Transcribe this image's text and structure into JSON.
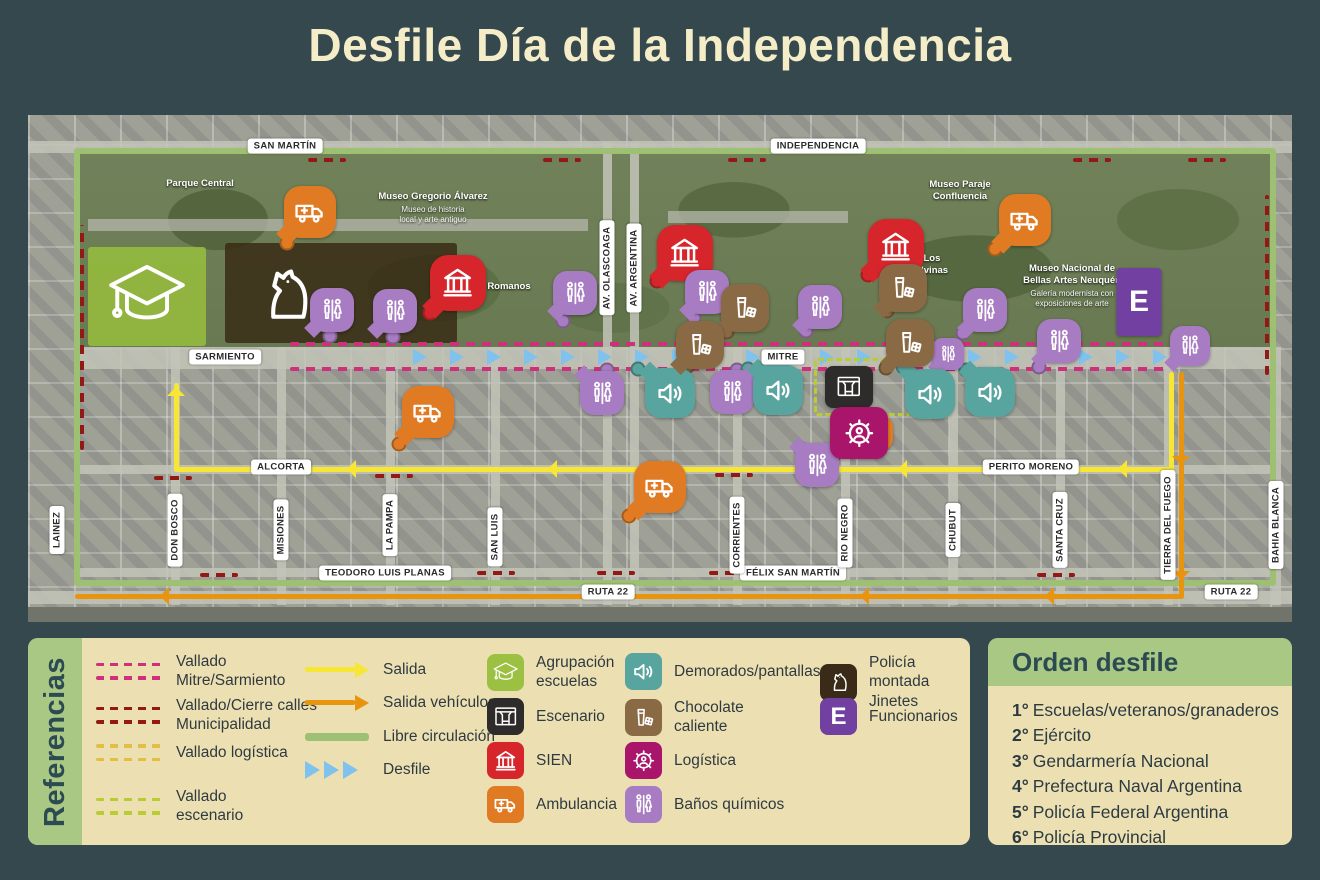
{
  "title": "Desfile Día de la Independencia",
  "map": {
    "street_labels": [
      {
        "text": "SAN MARTÍN",
        "x": 257,
        "y": 31
      },
      {
        "text": "INDEPENDENCIA",
        "x": 790,
        "y": 31
      },
      {
        "text": "SARMIENTO",
        "x": 197,
        "y": 242
      },
      {
        "text": "MITRE",
        "x": 755,
        "y": 242
      },
      {
        "text": "ALCORTA",
        "x": 253,
        "y": 352
      },
      {
        "text": "PERITO MORENO",
        "x": 1003,
        "y": 352
      },
      {
        "text": "TEODORO LUIS PLANAS",
        "x": 357,
        "y": 458
      },
      {
        "text": "FÉLIX SAN MARTÍN",
        "x": 765,
        "y": 458
      },
      {
        "text": "RUTA 22",
        "x": 580,
        "y": 477
      },
      {
        "text": "RUTA 22",
        "x": 1203,
        "y": 477
      },
      {
        "text": "LAINEZ",
        "x": 29,
        "y": 415,
        "v": 1
      },
      {
        "text": "DON BOSCO",
        "x": 147,
        "y": 415,
        "v": 1
      },
      {
        "text": "MISIONES",
        "x": 253,
        "y": 415,
        "v": 1
      },
      {
        "text": "LA PAMPA",
        "x": 362,
        "y": 410,
        "v": 1
      },
      {
        "text": "SAN LUIS",
        "x": 467,
        "y": 422,
        "v": 1
      },
      {
        "text": "CORRIENTES",
        "x": 709,
        "y": 420,
        "v": 1
      },
      {
        "text": "RIO NEGRO",
        "x": 817,
        "y": 418,
        "v": 1
      },
      {
        "text": "CHUBUT",
        "x": 925,
        "y": 415,
        "v": 1
      },
      {
        "text": "SANTA CRUZ",
        "x": 1032,
        "y": 415,
        "v": 1
      },
      {
        "text": "TIERRA DEL FUEGO",
        "x": 1140,
        "y": 410,
        "v": 1
      },
      {
        "text": "BAHIA BLANCA",
        "x": 1248,
        "y": 410,
        "v": 1
      },
      {
        "text": "AV. OLASCOAGA",
        "x": 579,
        "y": 153,
        "v": 1
      },
      {
        "text": "AV. ARGENTINA",
        "x": 606,
        "y": 153,
        "v": 1
      }
    ],
    "place_labels": [
      {
        "text": "Parque Central",
        "x": 172,
        "y": 69
      },
      {
        "text": "Museo Gregorio Álvarez",
        "x": 405,
        "y": 82
      },
      {
        "text": "Museo de historia\nlocal y arte antiguo",
        "x": 405,
        "y": 100,
        "sub": 1
      },
      {
        "text": "Museo Paraje\nConfluencia",
        "x": 932,
        "y": 76
      },
      {
        "text": "s Romanos",
        "x": 477,
        "y": 172
      },
      {
        "text": "a Los\nMalvinas",
        "x": 900,
        "y": 150
      },
      {
        "text": "Museo Nacional de\nBellas Artes Neuquén",
        "x": 1044,
        "y": 160
      },
      {
        "text": "Galería modernista con\nexposiciones de arte",
        "x": 1044,
        "y": 184,
        "sub": 1
      }
    ],
    "markers": [
      {
        "t": "amb",
        "x": 282,
        "y": 97,
        "s": 52,
        "tail": "bl",
        "dot": [
          259,
          128
        ]
      },
      {
        "t": "amb",
        "x": 997,
        "y": 105,
        "s": 52,
        "tail": "bl",
        "dot": [
          967,
          134
        ]
      },
      {
        "t": "amb",
        "x": 400,
        "y": 297,
        "s": 52,
        "tail": "bl",
        "dot": [
          371,
          329
        ]
      },
      {
        "t": "amb",
        "x": 632,
        "y": 372,
        "s": 52,
        "tail": "bl",
        "dot": [
          601,
          401
        ]
      },
      {
        "t": "amb",
        "x": 848,
        "y": 318,
        "s": 34,
        "tail": "bl",
        "dot": [
          833,
          335
        ]
      },
      {
        "t": "sien",
        "x": 430,
        "y": 168,
        "s": 56,
        "tail": "bl",
        "dot": [
          402,
          198
        ]
      },
      {
        "t": "sien",
        "x": 657,
        "y": 138,
        "s": 56,
        "tail": "bl",
        "dot": [
          629,
          166
        ]
      },
      {
        "t": "sien",
        "x": 868,
        "y": 132,
        "s": 56,
        "tail": "bl",
        "dot": [
          840,
          160
        ]
      },
      {
        "t": "banos",
        "x": 304,
        "y": 195,
        "s": 44,
        "tail": "bl",
        "dot": [
          302,
          221
        ]
      },
      {
        "t": "banos",
        "x": 367,
        "y": 196,
        "s": 44,
        "tail": "bl",
        "dot": [
          365,
          222
        ]
      },
      {
        "t": "banos",
        "x": 547,
        "y": 178,
        "s": 44,
        "tail": "bl",
        "dot": [
          535,
          206
        ]
      },
      {
        "t": "banos",
        "x": 679,
        "y": 177,
        "s": 44,
        "tail": "bl",
        "dot": [
          666,
          203
        ]
      },
      {
        "t": "banos",
        "x": 792,
        "y": 192,
        "s": 44,
        "tail": "bl",
        "dot": [
          778,
          216
        ]
      },
      {
        "t": "banos",
        "x": 957,
        "y": 195,
        "s": 44,
        "tail": "bl",
        "dot": [
          935,
          218
        ]
      },
      {
        "t": "banos",
        "x": 1031,
        "y": 226,
        "s": 44,
        "tail": "bl",
        "dot": [
          1011,
          252
        ]
      },
      {
        "t": "banos",
        "x": 1162,
        "y": 231,
        "s": 40,
        "tail": "bl"
      },
      {
        "t": "banos",
        "x": 574,
        "y": 278,
        "s": 44,
        "tail": "tl",
        "dot": [
          579,
          255
        ]
      },
      {
        "t": "banos",
        "x": 704,
        "y": 277,
        "s": 44,
        "tail": "tr",
        "dot": [
          709,
          255
        ]
      },
      {
        "t": "banos",
        "x": 789,
        "y": 350,
        "s": 44,
        "tail": "tl",
        "dot": [
          772,
          333
        ]
      },
      {
        "t": "banos",
        "x": 920,
        "y": 239,
        "s": 32,
        "tail": "bl"
      },
      {
        "t": "speaker",
        "x": 642,
        "y": 278,
        "s": 50,
        "tail": "tl",
        "dot": [
          610,
          254
        ]
      },
      {
        "t": "speaker",
        "x": 750,
        "y": 275,
        "s": 50,
        "tail": "tl",
        "dot": [
          720,
          254
        ]
      },
      {
        "t": "speaker",
        "x": 902,
        "y": 279,
        "s": 50,
        "tail": "tl",
        "dot": [
          875,
          252
        ]
      },
      {
        "t": "speaker",
        "x": 962,
        "y": 277,
        "s": 50,
        "tail": "tl",
        "dot": [
          938,
          255
        ]
      },
      {
        "t": "choc",
        "x": 717,
        "y": 193,
        "s": 48,
        "tail": "bl",
        "dot": [
          699,
          217
        ]
      },
      {
        "t": "choc",
        "x": 875,
        "y": 173,
        "s": 48,
        "tail": "bl",
        "dot": [
          859,
          196
        ]
      },
      {
        "t": "choc",
        "x": 672,
        "y": 230,
        "s": 48,
        "tail": "bl",
        "dot": [
          660,
          251
        ]
      },
      {
        "t": "choc",
        "x": 882,
        "y": 228,
        "s": 48,
        "tail": "bl",
        "dot": [
          858,
          253
        ]
      }
    ]
  },
  "marker_colors": {
    "amb": "#e07b24",
    "sien": "#d6252b",
    "banos": "#a87cc2",
    "speaker": "#58a49e",
    "choc": "#8a6a44"
  },
  "legend": {
    "title": "Referencias",
    "barriers": [
      {
        "label": "Vallado\nMitre/Sarmiento",
        "color": "#cf2f7b"
      },
      {
        "label": "Vallado/Cierre calles\nMunicipalidad",
        "color": "#921914"
      },
      {
        "label": "Vallado logística",
        "color": "#e4bd45"
      },
      {
        "label": "Vallado\nescenario",
        "color": "#b9cc33"
      }
    ],
    "routes": [
      {
        "label": "Salida",
        "color": "#f7e633",
        "type": "arrow"
      },
      {
        "label": "Salida vehículos",
        "color": "#e8940f",
        "type": "arrow"
      },
      {
        "label": "Libre circulación",
        "color": "#9ec073",
        "type": "line"
      },
      {
        "label": "Desfile",
        "color": "#7fc2ee",
        "type": "triangles"
      }
    ],
    "icons": [
      {
        "label": "Agrupación\nescuelas",
        "color": "#9cc041",
        "icon": "cap"
      },
      {
        "label": "Escenario",
        "color": "#2e2c2a",
        "icon": "stage"
      },
      {
        "label": "SIEN",
        "color": "#d6252b",
        "icon": "sien"
      },
      {
        "label": "Ambulancia",
        "color": "#e07b24",
        "icon": "amb"
      },
      {
        "label": "Demorados/pantallas",
        "color": "#58a49e",
        "icon": "speaker"
      },
      {
        "label": "Chocolate\ncaliente",
        "color": "#8a6a44",
        "icon": "choc"
      },
      {
        "label": "Logística",
        "color": "#a8156a",
        "icon": "gear"
      },
      {
        "label": "Baños químicos",
        "color": "#a87cc2",
        "icon": "banos"
      },
      {
        "label": "Policía montada\nJinetes",
        "color": "#3a2b18",
        "icon": "horse"
      },
      {
        "label": "Funcionarios",
        "color": "#7140a1",
        "symbol": "E"
      }
    ]
  },
  "orden": {
    "title": "Orden desfile",
    "items": [
      {
        "num": "1°",
        "text": "Escuelas/veteranos/granaderos"
      },
      {
        "num": "2°",
        "text": "Ejército"
      },
      {
        "num": "3°",
        "text": "Gendarmería Nacional"
      },
      {
        "num": "4°",
        "text": "Prefectura Naval Argentina"
      },
      {
        "num": "5°",
        "text": "Policía Federal Argentina"
      },
      {
        "num": "6°",
        "text": "Policía Provincial"
      }
    ]
  }
}
